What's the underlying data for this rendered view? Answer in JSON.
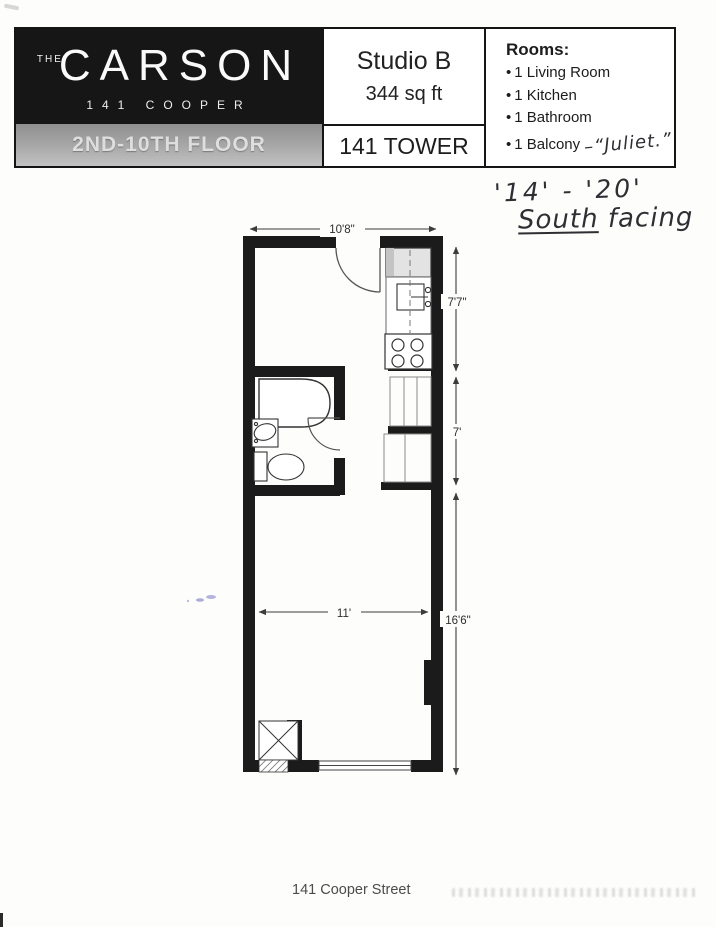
{
  "header": {
    "logo": {
      "the": "THE",
      "name": "CARSON",
      "address": "141 COOPER"
    },
    "floor_band": "2ND-10TH FLOOR",
    "unit_name": "Studio B",
    "unit_area": "344 sq ft",
    "tower": "141 TOWER",
    "rooms": {
      "title": "Rooms:",
      "items": [
        "1 Living Room",
        "1 Kitchen",
        "1 Bathroom",
        "1 Balcony"
      ],
      "balcony_note": "–“Juliet.”"
    }
  },
  "handwritten": {
    "floors": "'14' - '20'",
    "facing_underlined": "South",
    "facing_rest": " facing"
  },
  "plan": {
    "dims": {
      "top_width": "10'8\"",
      "kitchen_depth": "7'7\"",
      "closet_depth": "7'",
      "living_width": "11'",
      "living_depth": "16'6\""
    }
  },
  "footer": {
    "address": "141 Cooper Street"
  }
}
